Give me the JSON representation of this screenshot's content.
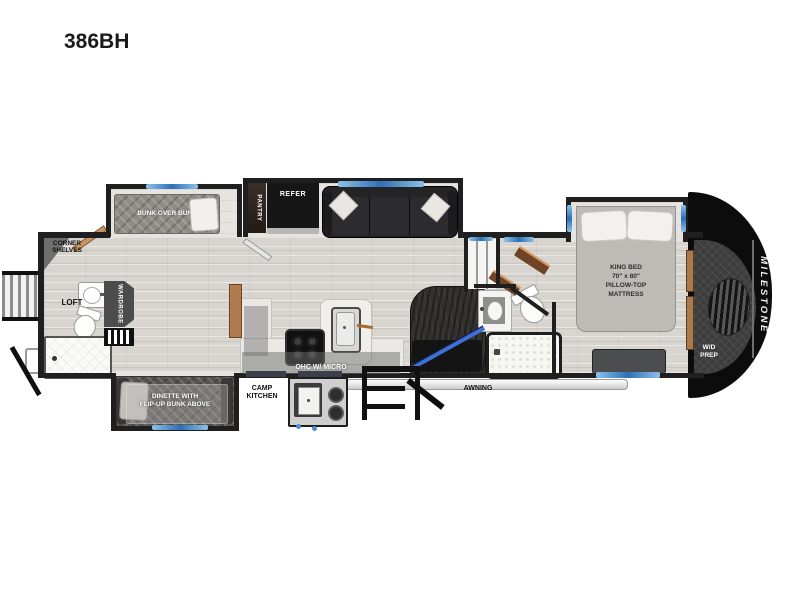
{
  "title": "386BH",
  "brand": {
    "logo": "MILESTONE"
  },
  "colors": {
    "wall": "#1f1f1f",
    "front_cap": "#0c0c0c",
    "window_accent": "#2f6fb5",
    "floor": "#d8d5d0",
    "stair_rail": "#3f6fd8"
  },
  "rooms": {
    "rear_bath": {
      "corner_shelves": "CORNER\nSHELVES",
      "loft": "LOFT"
    },
    "bunk_room": {
      "wardrobe": "WARDROBE",
      "bunk_over_bunk": "BUNK OVER BUNK",
      "dinette": "DINETTE WITH\nFLIP-UP BUNK ABOVE"
    },
    "kitchen": {
      "pantry": "PANTRY",
      "refer": "REFER",
      "ohc": "OHC W/ MICRO"
    },
    "exterior": {
      "camp_kitchen": "CAMP\nKITCHEN",
      "awning": "AWNING"
    },
    "bedroom": {
      "king_bed": "KING BED\n70\" x 80\"\nPILLOW-TOP\nMATTRESS",
      "wd_prep": "W/D\nPREP"
    }
  }
}
